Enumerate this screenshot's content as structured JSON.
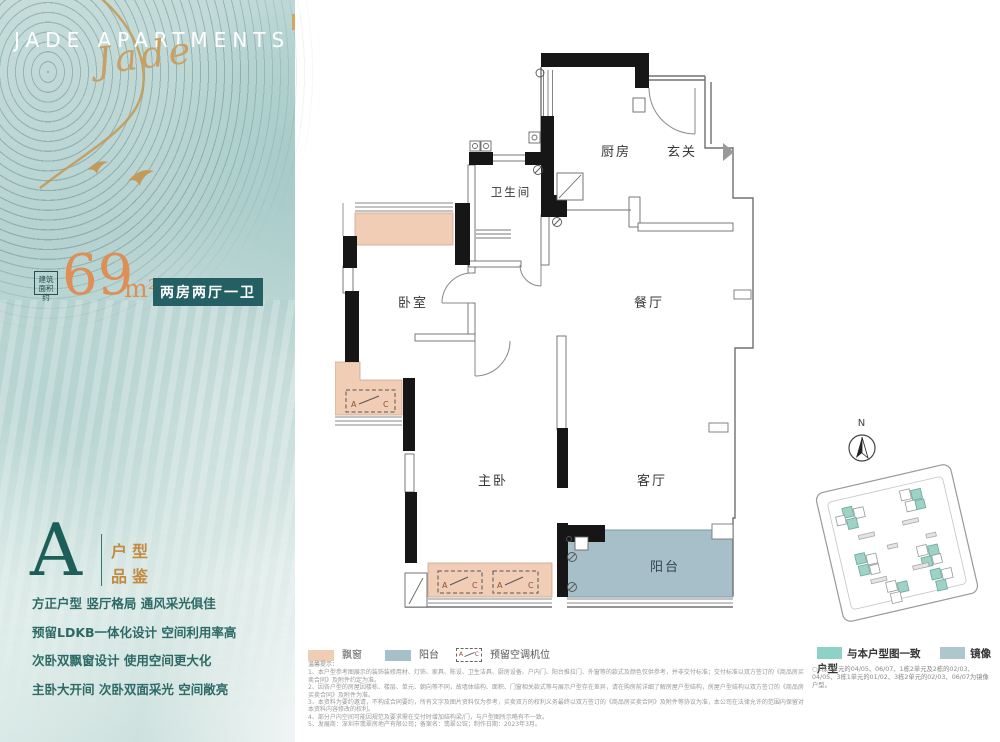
{
  "brand": {
    "title": "JADE APARTMENTS",
    "script": "Jade"
  },
  "area": {
    "prefix1": "建筑",
    "prefix2": "面积约",
    "value": "69",
    "unit": "m²",
    "layout": "两房两厅一卫"
  },
  "unit": {
    "letter": "A",
    "tag1": "户型",
    "tag2": "品鉴"
  },
  "features": [
    "方正户型  竖厅格局  通风采光俱佳",
    "预留LDKB一体化设计 空间利用率高",
    "次卧双飘窗设计  使用空间更大化",
    "主卧大开间 次卧双面采光 空间敞亮"
  ],
  "plan": {
    "rooms": {
      "kitchen": "厨房",
      "foyer": "玄关",
      "bath": "卫生间",
      "bedroom": "卧室",
      "dining": "餐厅",
      "master": "主卧",
      "living": "客厅",
      "balcony": "阳台"
    },
    "ac_a": "A",
    "ac_c": "C"
  },
  "legend": {
    "bay": "飘窗",
    "balcony": "阳台",
    "ac": "预留空调机位"
  },
  "site_legend": {
    "same": "与本户型图一致",
    "mirror": "镜像户型",
    "note": "○1栋1单元的04/05、06/07、1栋2单元及2栋的02/03、04/05、3栋1单元的01/02、3栋2单元的02/03、06/07为镜像户型。"
  },
  "compass": {
    "label": "N"
  },
  "notes": {
    "title": "温馨提示：",
    "items": [
      "1、本户型参考图展示的装饰装修用材、灯饰、家具、陈设、卫生洁具、厨房设备、户内门、阳台推拉门、外窗等的款式及颜色仅供参考，并非交付标准；交付标准以双方签订的《商品房买卖合同》及附件约定为准。",
      "2、因各户型的房屋因楼栋、楼层、单元、朝向等不同，故墙体结构、面积、门窗相关款式等与展示户型存在差异，请在购房前详细了解房屋户型结构，房屋户型结构以双方签订的《商品房买卖合同》及附件为准。",
      "3、本资料为要约邀请，不构成合同要约，所有文字及图片资料仅为参考，买卖双方的权利义务最终以双方签订的《商品房买卖合同》及附件等协议为准，本公司在法律允许的范围内保留对本资料内容修改的权利。",
      "4、部分户内空间可能因规范及要求需在交付时增加结构梁/门，与户型图所示略有不一致。",
      "5、发展商：深圳市翡翠房地产有限公司；备案名：翡翠公馆；制作日期：2023年3月。"
    ]
  },
  "colors": {
    "accent_orange": "#dd8f55",
    "teal_dark": "#235f63",
    "gold": "#c9a063",
    "bay_pink": "#f2cdb6",
    "balcony_blue": "#a7bfc8",
    "legend_teal": "#8ed1c6",
    "legend_blue": "#aec6ce"
  }
}
